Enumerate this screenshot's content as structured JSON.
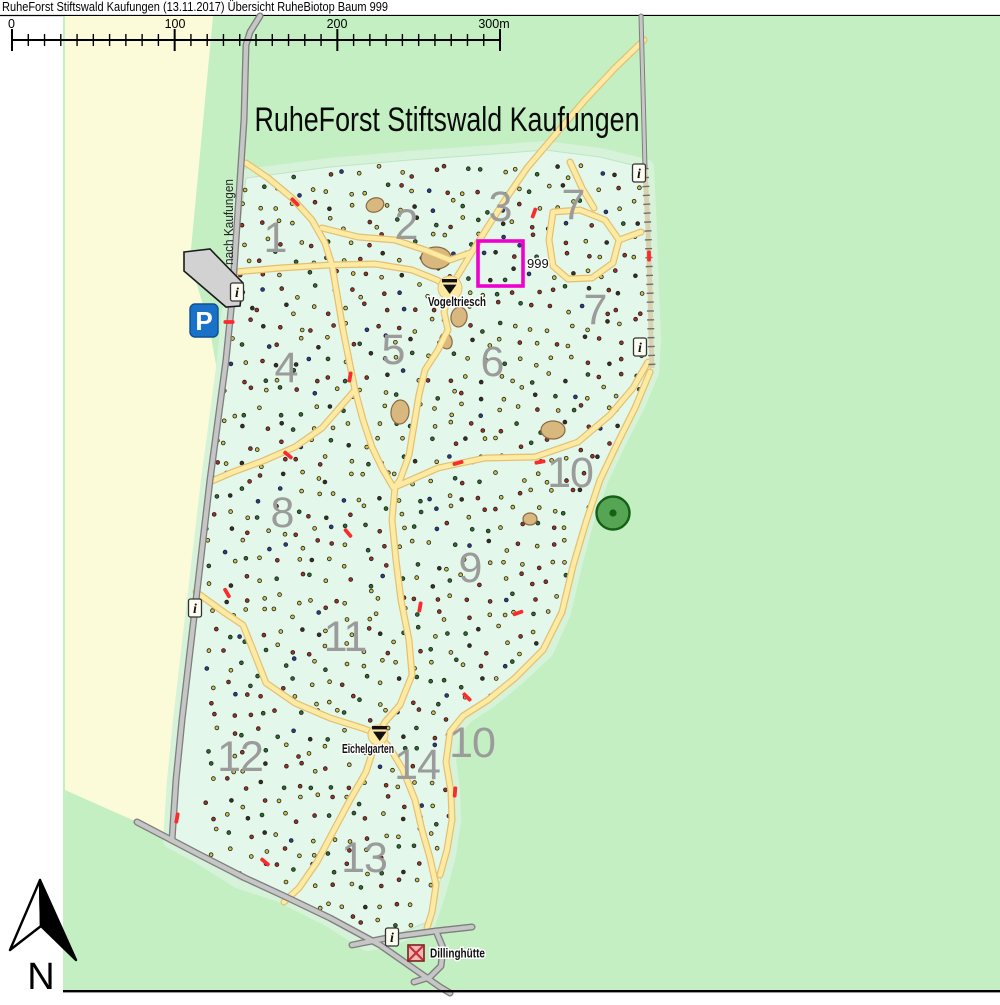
{
  "window": {
    "title": "RuheForst Stiftswald Kaufungen (13.11.2017) Übersicht RuheBiotop Baum 999"
  },
  "scale_bar": {
    "labels": [
      {
        "text": "0",
        "x": 12
      },
      {
        "text": "100",
        "x": 175
      },
      {
        "text": "200",
        "x": 337
      },
      {
        "text": "300m",
        "x": 494
      }
    ],
    "x0": 12,
    "x1": 500,
    "y": 40,
    "minor_intervals": 30,
    "major_intervals": 3
  },
  "map": {
    "title": "RuheForst Stiftswald Kaufungen",
    "road_label": "nach Kaufungen",
    "north_label": "N",
    "highlight": {
      "label": "999"
    },
    "sections": [
      {
        "label": "1",
        "x": 275,
        "y": 238
      },
      {
        "label": "2",
        "x": 406,
        "y": 225
      },
      {
        "label": "3",
        "x": 500,
        "y": 207
      },
      {
        "label": "4",
        "x": 286,
        "y": 368
      },
      {
        "label": "5",
        "x": 393,
        "y": 350
      },
      {
        "label": "6",
        "x": 492,
        "y": 362
      },
      {
        "label": "7",
        "x": 573,
        "y": 205
      },
      {
        "label": "7",
        "x": 595,
        "y": 310
      },
      {
        "label": "8",
        "x": 282,
        "y": 513
      },
      {
        "label": "9",
        "x": 470,
        "y": 568
      },
      {
        "label": "10",
        "x": 570,
        "y": 473
      },
      {
        "label": "10",
        "x": 472,
        "y": 743
      },
      {
        "label": "11",
        "x": 345,
        "y": 637
      },
      {
        "label": "12",
        "x": 240,
        "y": 757
      },
      {
        "label": "13",
        "x": 364,
        "y": 858
      },
      {
        "label": "14",
        "x": 417,
        "y": 765
      }
    ],
    "places": [
      {
        "name": "Vogeltriesch"
      },
      {
        "name": "Eichelgarten"
      },
      {
        "name": "Dillinghütte"
      }
    ],
    "icons": {
      "parking_label": "P",
      "info_glyph": "i",
      "info_positions": [
        [
          237,
          292
        ],
        [
          639,
          173
        ],
        [
          640,
          347
        ],
        [
          195,
          608
        ],
        [
          392,
          937
        ]
      ],
      "biotope_tree": {
        "x": 613,
        "y": 513
      }
    },
    "colors": {
      "outer_green": "#c3efc3",
      "forest_mint": "#e3f7ea",
      "forest_halo": "#d6f3da",
      "field_yellow": "#fbfbda",
      "path_yellow": "#ffeaa4",
      "path_edge": "#e2c070",
      "road_gray": "#c6c6c6",
      "road_edge": "#7e7e7e",
      "highlight_magenta": "#f000d0",
      "marker_red": "#f82c2c",
      "parking_blue": "#1a72c8",
      "tree_green": "#55a555"
    }
  }
}
